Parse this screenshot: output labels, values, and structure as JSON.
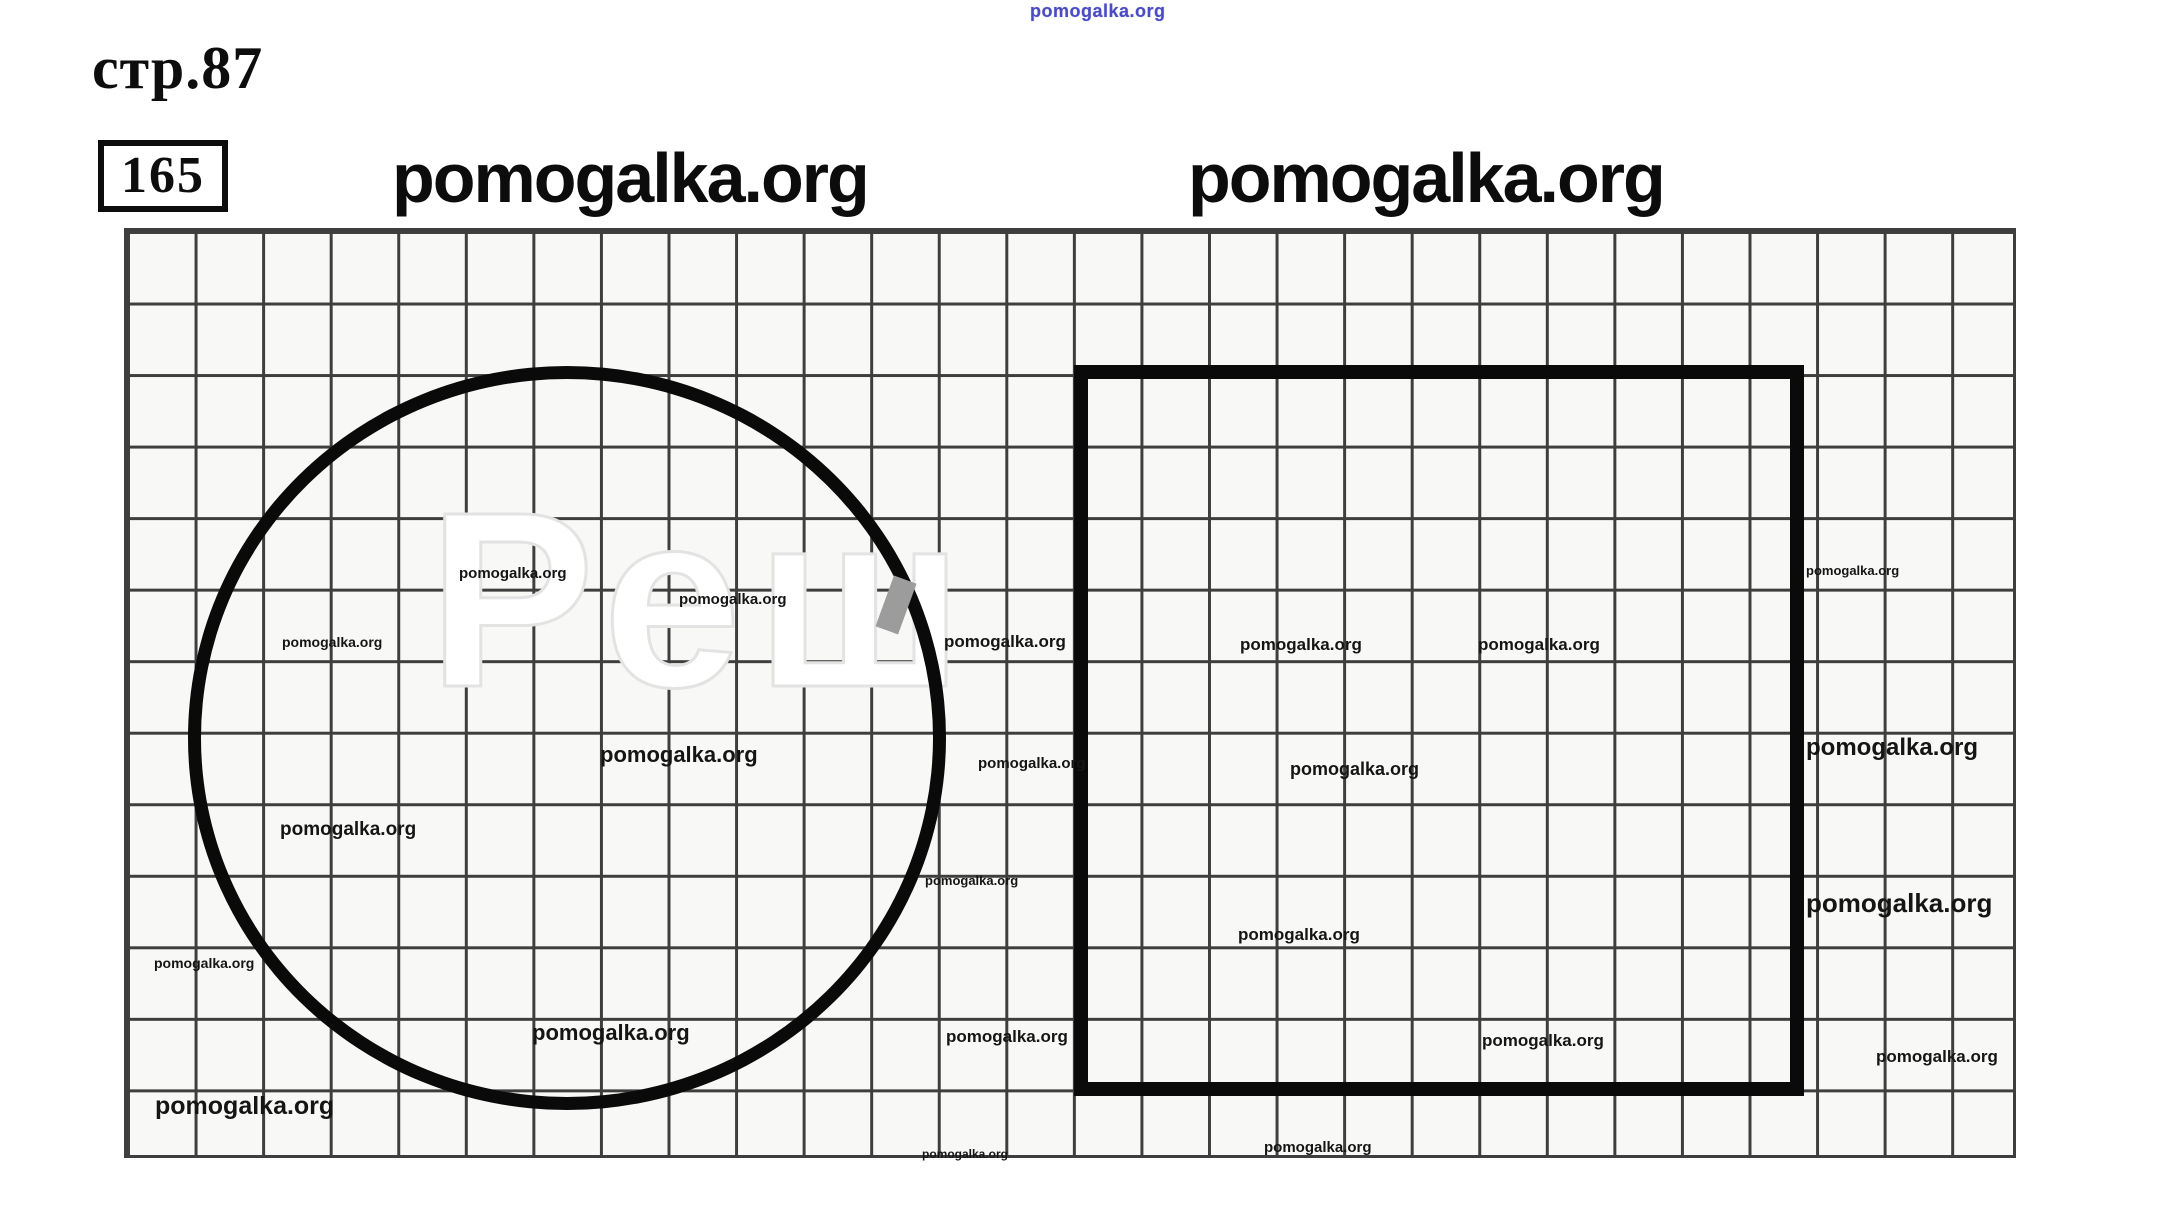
{
  "page": {
    "heading_label": "стр.87",
    "task_number": "165"
  },
  "watermark_headings": {
    "top_small_blue": "pomogalka.org",
    "left": "pomogalka.org",
    "right": "pomogalka.org"
  },
  "figure": {
    "ghost_watermark_text": "Реш",
    "grid_columns": 28,
    "grid_rows": 13,
    "shapes": [
      "circle",
      "square"
    ]
  },
  "colors": {
    "ink": "#0c0c0c",
    "grid_line": "#3e3e3e",
    "shape_stroke": "#0a0a0a",
    "blue_watermark": "#4b4bc4",
    "paper": "#f8f8f6"
  },
  "watermarks": {
    "text": "pomogalka.org",
    "items": [
      {
        "x": 459,
        "y": 566,
        "size": 15
      },
      {
        "x": 679,
        "y": 592,
        "size": 15
      },
      {
        "x": 282,
        "y": 635,
        "size": 14
      },
      {
        "x": 944,
        "y": 633,
        "size": 17
      },
      {
        "x": 1240,
        "y": 636,
        "size": 17
      },
      {
        "x": 1478,
        "y": 636,
        "size": 17
      },
      {
        "x": 1806,
        "y": 564,
        "size": 13
      },
      {
        "x": 600,
        "y": 744,
        "size": 22
      },
      {
        "x": 978,
        "y": 756,
        "size": 15
      },
      {
        "x": 1290,
        "y": 760,
        "size": 18
      },
      {
        "x": 1806,
        "y": 736,
        "size": 24
      },
      {
        "x": 280,
        "y": 820,
        "size": 19
      },
      {
        "x": 925,
        "y": 874,
        "size": 13
      },
      {
        "x": 1238,
        "y": 926,
        "size": 17
      },
      {
        "x": 1806,
        "y": 890,
        "size": 26
      },
      {
        "x": 154,
        "y": 956,
        "size": 14
      },
      {
        "x": 532,
        "y": 1022,
        "size": 22
      },
      {
        "x": 946,
        "y": 1028,
        "size": 17
      },
      {
        "x": 1482,
        "y": 1032,
        "size": 17
      },
      {
        "x": 1876,
        "y": 1048,
        "size": 17
      },
      {
        "x": 155,
        "y": 1094,
        "size": 25
      },
      {
        "x": 922,
        "y": 1148,
        "size": 12
      },
      {
        "x": 1264,
        "y": 1140,
        "size": 15
      }
    ]
  }
}
